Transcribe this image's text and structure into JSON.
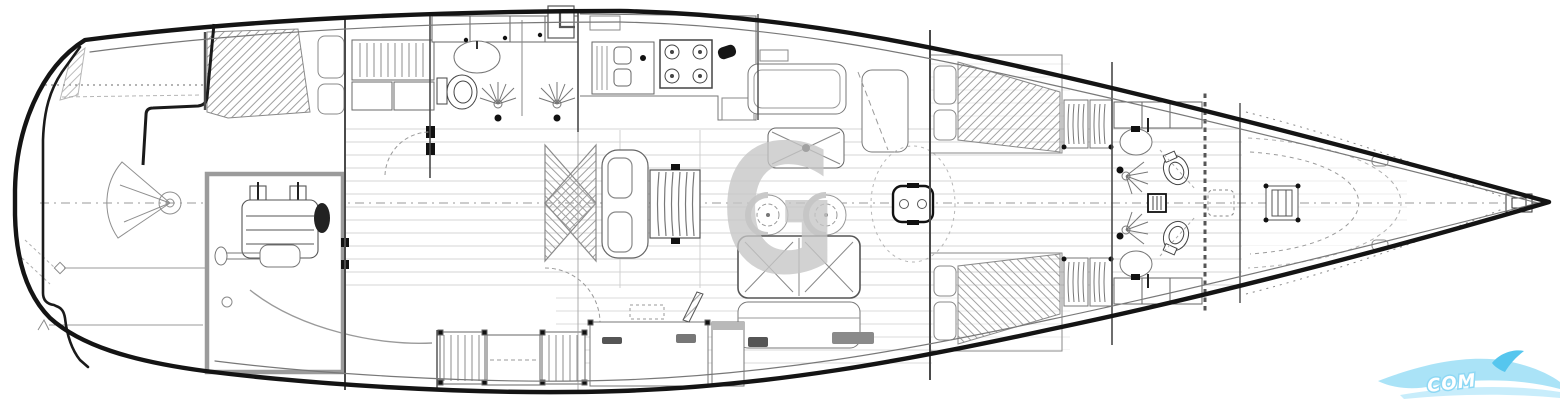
{
  "plan": {
    "type": "sailing-yacht-interior-deck-plan",
    "orientation": "bow-right-stern-left"
  },
  "watermark": {
    "letter": "G",
    "color": "#c5c5c5"
  },
  "logo": {
    "text": "COM",
    "text_color": "#ffffff",
    "text_halo": "#8ed8f4",
    "wave_primary": "#a5e1f7",
    "wave_secondary": "#56c6ee",
    "wave_light": "#c8edfb"
  },
  "drawing": {
    "background": "#ffffff",
    "hull_stroke": "#141414",
    "line": "#5a5a5a",
    "light_line": "#9a9a9a",
    "plank_line": "#dcdcdc",
    "hatch_line": "#a0a0a0",
    "gray_fill": "#c9c9c9",
    "accent_black": "#111111"
  }
}
